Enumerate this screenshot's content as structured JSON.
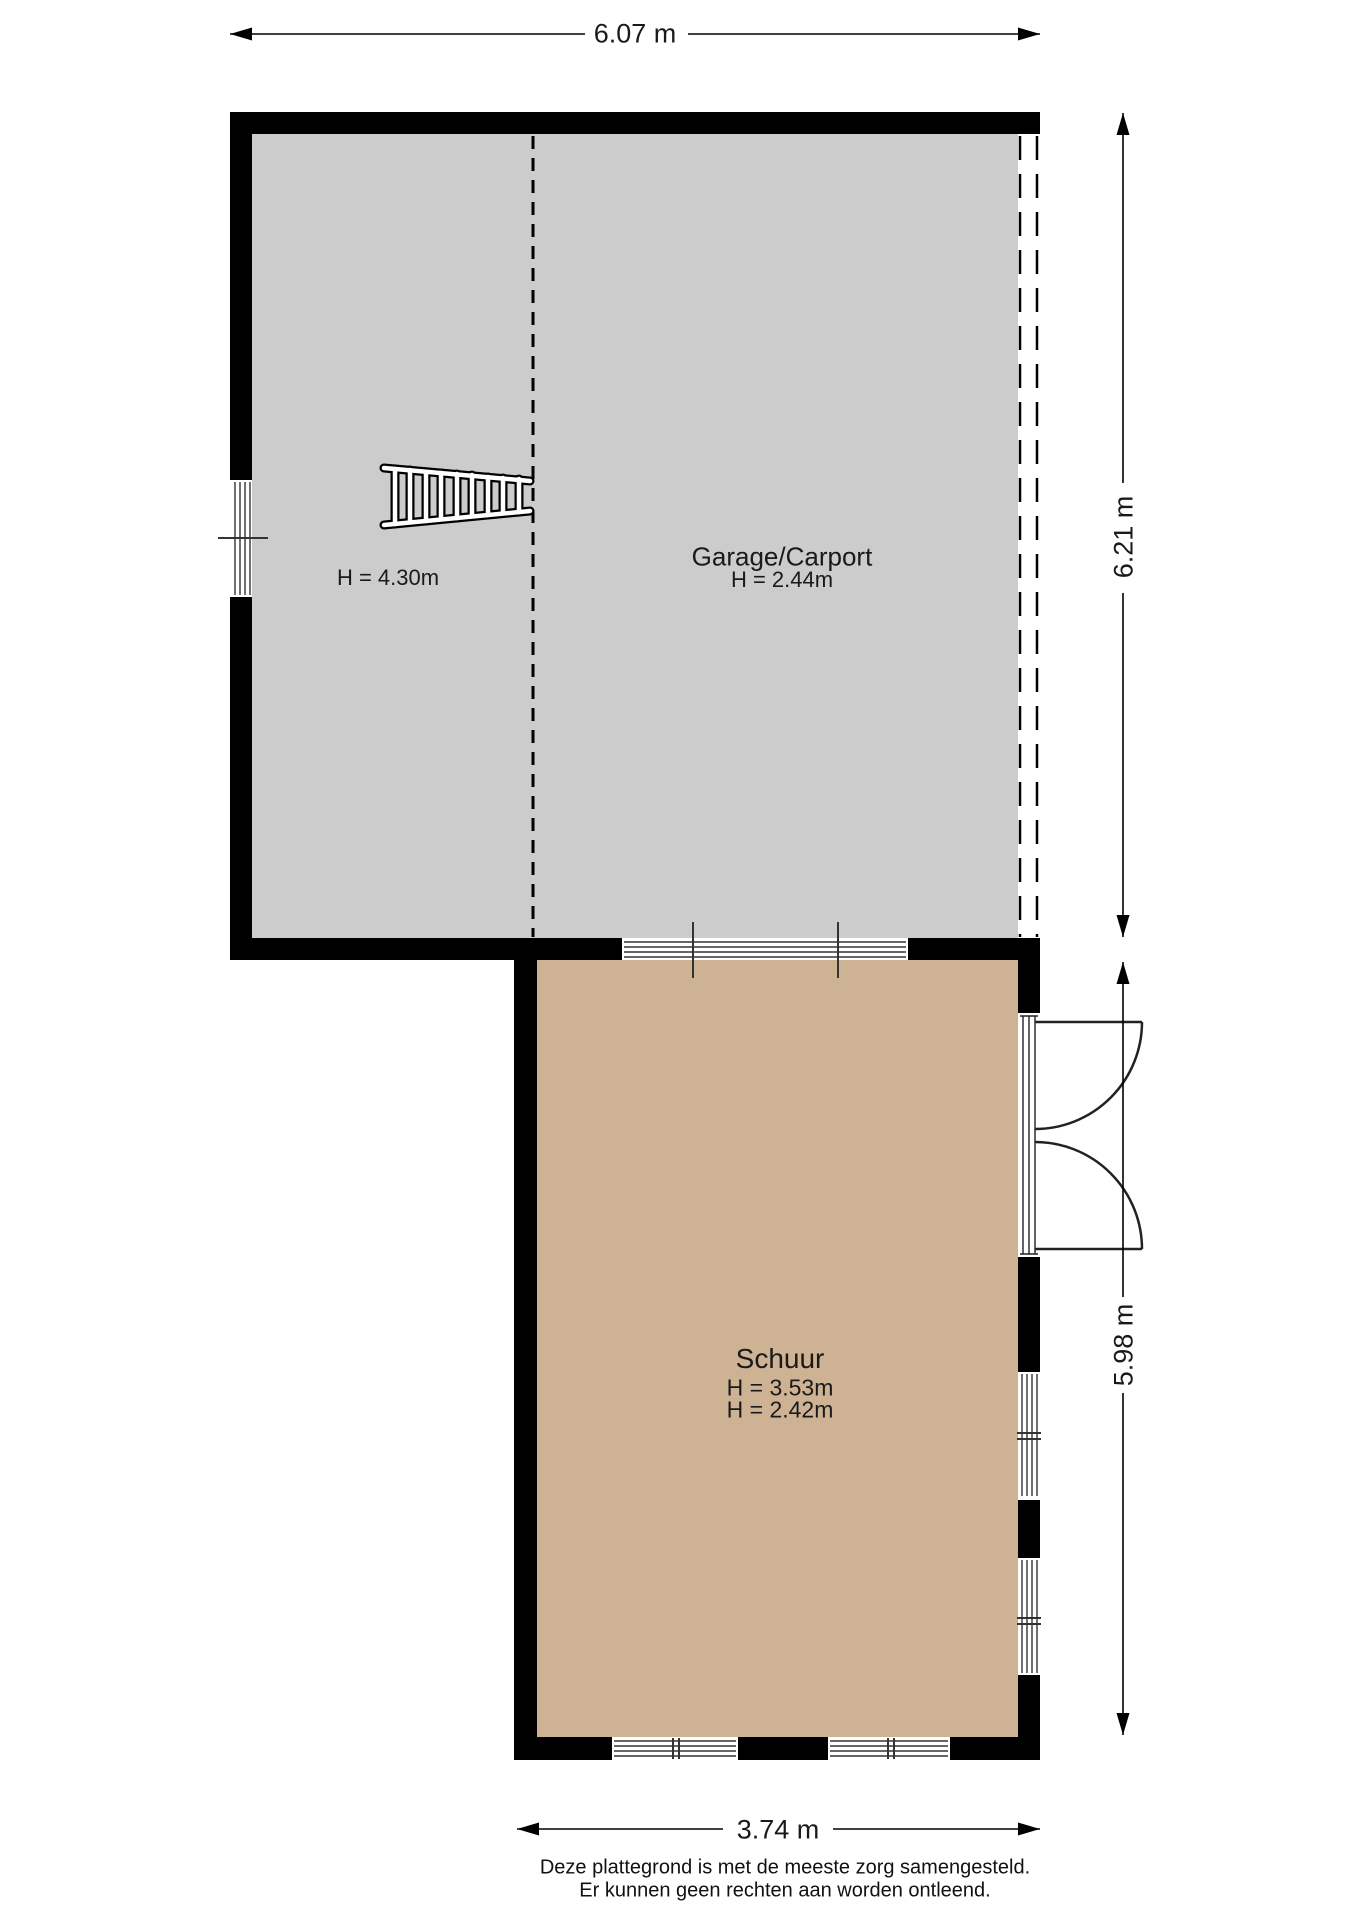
{
  "plan": {
    "rooms": [
      {
        "id": "garage",
        "label": "Garage/Carport",
        "height_label": "H = 2.44m"
      },
      {
        "id": "attic-zone",
        "label": "",
        "height_label": "H = 4.30m"
      },
      {
        "id": "schuur",
        "label": "Schuur",
        "height_label_1": "H = 3.53m",
        "height_label_2": "H = 2.42m"
      }
    ],
    "dimensions": {
      "top": "6.07 m",
      "right_upper": "6.21 m",
      "right_lower": "5.98 m",
      "bottom": "3.74 m"
    },
    "footer": {
      "line1": "Deze plattegrond is met de meeste zorg samengesteld.",
      "line2": "Er kunnen geen rechten aan worden ontleend."
    },
    "colors": {
      "garage_fill": "#cccccc",
      "schuur_fill": "#cdb394",
      "wall": "#000000",
      "line": "#1a1a1a"
    }
  }
}
